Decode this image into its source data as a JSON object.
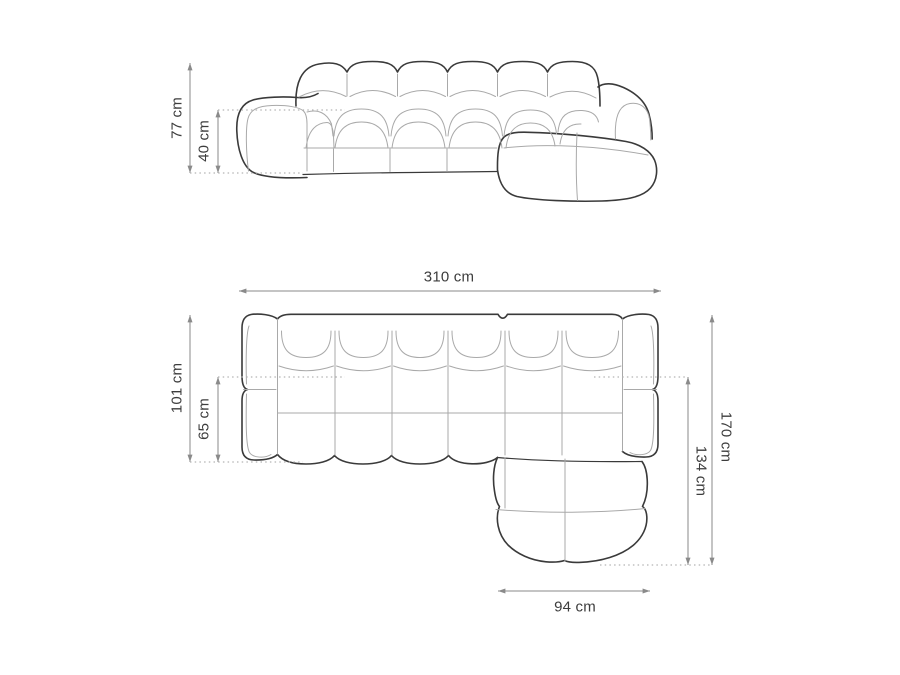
{
  "colors": {
    "background": "#ffffff",
    "outline": "#3a3a3a",
    "seam": "#a9a9a9",
    "dimension_line": "#8a8a8a",
    "dotted_line": "#b4b4b4",
    "label_text": "#3d3d3d"
  },
  "views": {
    "front_elevation": {
      "dimensions": [
        {
          "name": "overall-height",
          "label": "77 cm",
          "value_cm": 77
        },
        {
          "name": "seat-height",
          "label": "40 cm",
          "value_cm": 40
        }
      ]
    },
    "top_plan": {
      "dimensions": [
        {
          "name": "overall-width",
          "label": "310 cm",
          "value_cm": 310
        },
        {
          "name": "body-depth",
          "label": "101 cm",
          "value_cm": 101
        },
        {
          "name": "seat-depth",
          "label": "65 cm",
          "value_cm": 65
        },
        {
          "name": "overall-depth",
          "label": "170 cm",
          "value_cm": 170
        },
        {
          "name": "chaise-extent",
          "label": "134 cm",
          "value_cm": 134
        },
        {
          "name": "chaise-width",
          "label": "94 cm",
          "value_cm": 94
        }
      ]
    }
  }
}
